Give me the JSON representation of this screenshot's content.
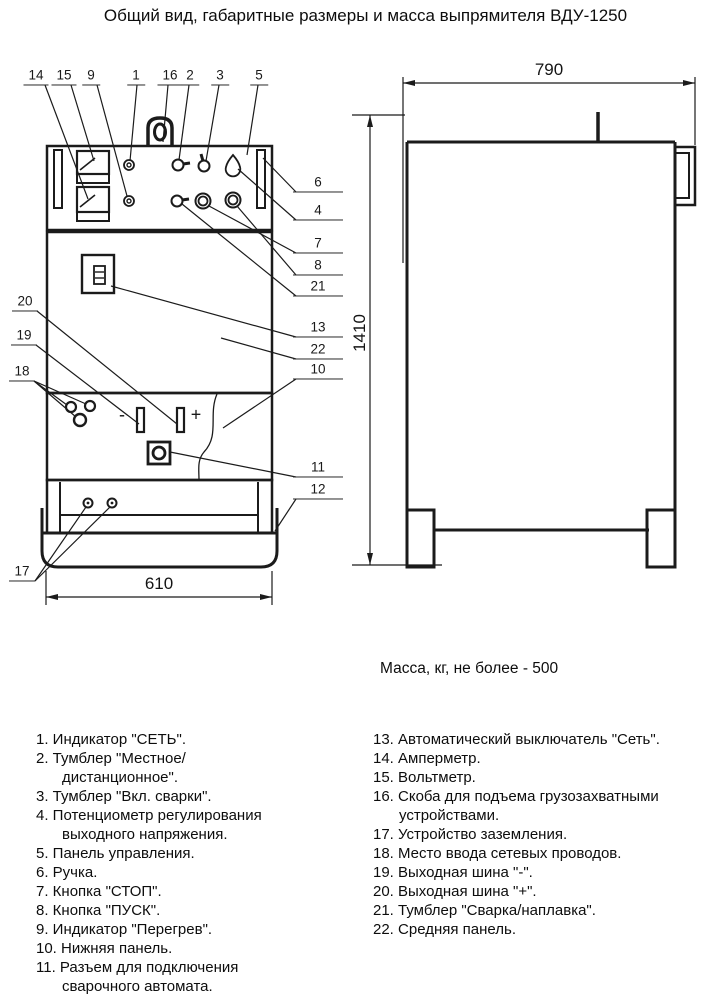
{
  "title": "Общий вид, габаритные размеры и масса выпрямителя ВДУ-1250",
  "mass_note": "Масса, кг, не более - 500",
  "dimensions": {
    "front_width": "610",
    "side_depth": "790",
    "height": "1410"
  },
  "drawing": {
    "callouts": [
      {
        "label": "14",
        "x": 36,
        "y": 85,
        "side": "top"
      },
      {
        "label": "15",
        "x": 64,
        "y": 85,
        "side": "top"
      },
      {
        "label": "9",
        "x": 91,
        "y": 85,
        "side": "top"
      },
      {
        "label": "1",
        "x": 136,
        "y": 85,
        "side": "top"
      },
      {
        "label": "16",
        "x": 170,
        "y": 85,
        "side": "top"
      },
      {
        "label": "2",
        "x": 190,
        "y": 85,
        "side": "top"
      },
      {
        "label": "3",
        "x": 220,
        "y": 85,
        "side": "top"
      },
      {
        "label": "5",
        "x": 259,
        "y": 85,
        "side": "top"
      },
      {
        "label": "6",
        "x": 318,
        "y": 192,
        "side": "right"
      },
      {
        "label": "4",
        "x": 318,
        "y": 220,
        "side": "right"
      },
      {
        "label": "7",
        "x": 318,
        "y": 253,
        "side": "right"
      },
      {
        "label": "8",
        "x": 318,
        "y": 275,
        "side": "right"
      },
      {
        "label": "21",
        "x": 318,
        "y": 296,
        "side": "right"
      },
      {
        "label": "13",
        "x": 318,
        "y": 337,
        "side": "right"
      },
      {
        "label": "22",
        "x": 318,
        "y": 359,
        "side": "right"
      },
      {
        "label": "10",
        "x": 318,
        "y": 379,
        "side": "right"
      },
      {
        "label": "11",
        "x": 318,
        "y": 477,
        "side": "right"
      },
      {
        "label": "12",
        "x": 318,
        "y": 499,
        "side": "right"
      },
      {
        "label": "20",
        "x": 25,
        "y": 311,
        "side": "left"
      },
      {
        "label": "19",
        "x": 24,
        "y": 345,
        "side": "left"
      },
      {
        "label": "18",
        "x": 22,
        "y": 381,
        "side": "left"
      },
      {
        "label": "17",
        "x": 22,
        "y": 581,
        "side": "left"
      },
      {
        "label": "-",
        "x": 122,
        "y": 425,
        "side": "bus"
      },
      {
        "label": "+",
        "x": 196,
        "y": 425,
        "side": "bus"
      }
    ]
  },
  "legend": {
    "left": [
      "1. Индикатор \"СЕТЬ\".",
      "2. Тумблер \"Местное/дистанционное\".",
      "3. Тумблер \"Вкл. сварки\".",
      "4. Потенциометр регулирования выходного напряжения.",
      "5. Панель управления.",
      "6. Ручка.",
      "7. Кнопка \"СТОП\".",
      "8. Кнопка \"ПУСК\".",
      "9. Индикатор \"Перегрев\".",
      "10. Нижняя панель.",
      "11. Разъем для подключения сварочного автомата.",
      "12. Опора."
    ],
    "right": [
      "13. Автоматический выключатель \"Сеть\".",
      "14. Амперметр.",
      "15. Вольтметр.",
      "16. Скоба для подъема грузозахватными устройствами.",
      "17. Устройство заземления.",
      "18. Место ввода сетевых проводов.",
      "19. Выходная шина \"-\".",
      "20. Выходная шина \"+\".",
      "21. Тумблер \"Сварка/наплавка\".",
      "22. Средняя панель."
    ]
  }
}
